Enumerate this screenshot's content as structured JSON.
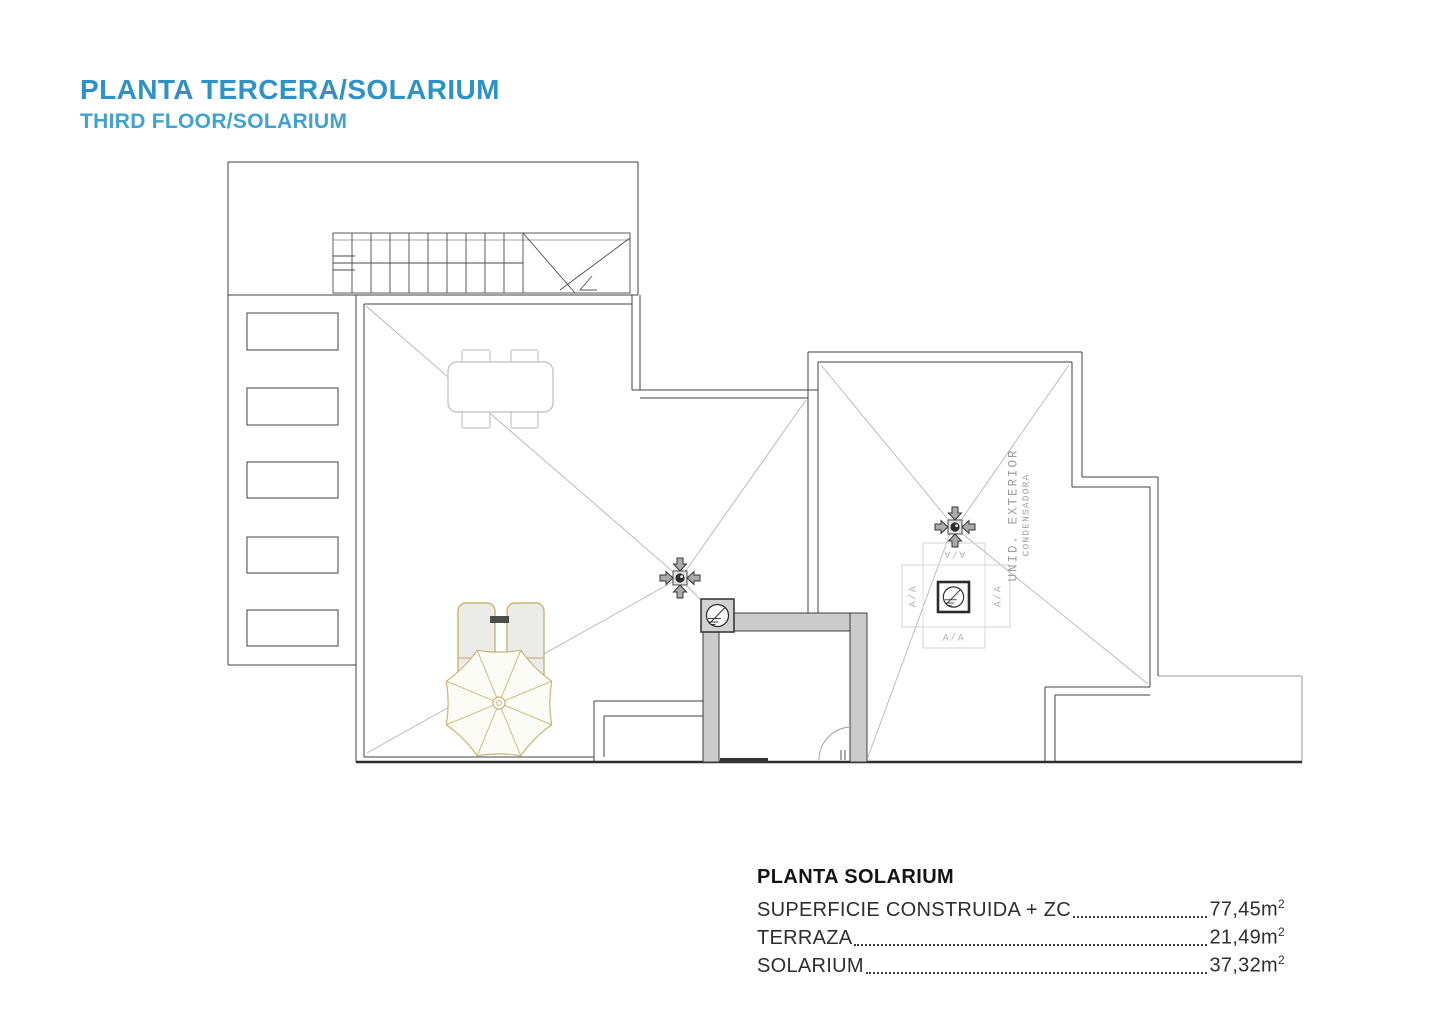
{
  "header": {
    "title": "PLANTA TERCERA/SOLARIUM",
    "subtitle": "THIRD FLOOR/SOLARIUM"
  },
  "colors": {
    "title_accent": "#2d93c6",
    "subtitle_accent": "#41a2d0",
    "wall_line": "#424242",
    "slope_line": "#b6b6b6",
    "elevator_fill": "#cbcbcb",
    "furniture_tan": "#c9b475"
  },
  "plan": {
    "ac_unit": {
      "label_top": "A/A",
      "label_left": "A/A",
      "label_right": "A/A",
      "label_bottom": "A/A",
      "name_line1": "UNID. EXTERIOR",
      "name_line2": "CONDENSADORA"
    }
  },
  "area_table": {
    "heading": "PLANTA SOLARIUM",
    "rows": [
      {
        "label": "SUPERFICIE CONSTRUIDA + ZC",
        "value": "77,45",
        "unit": "m",
        "exponent": "2"
      },
      {
        "label": "TERRAZA",
        "value": "21,49",
        "unit": "m",
        "exponent": "2"
      },
      {
        "label": "SOLARIUM",
        "value": "37,32",
        "unit": "m",
        "exponent": "2"
      }
    ]
  }
}
